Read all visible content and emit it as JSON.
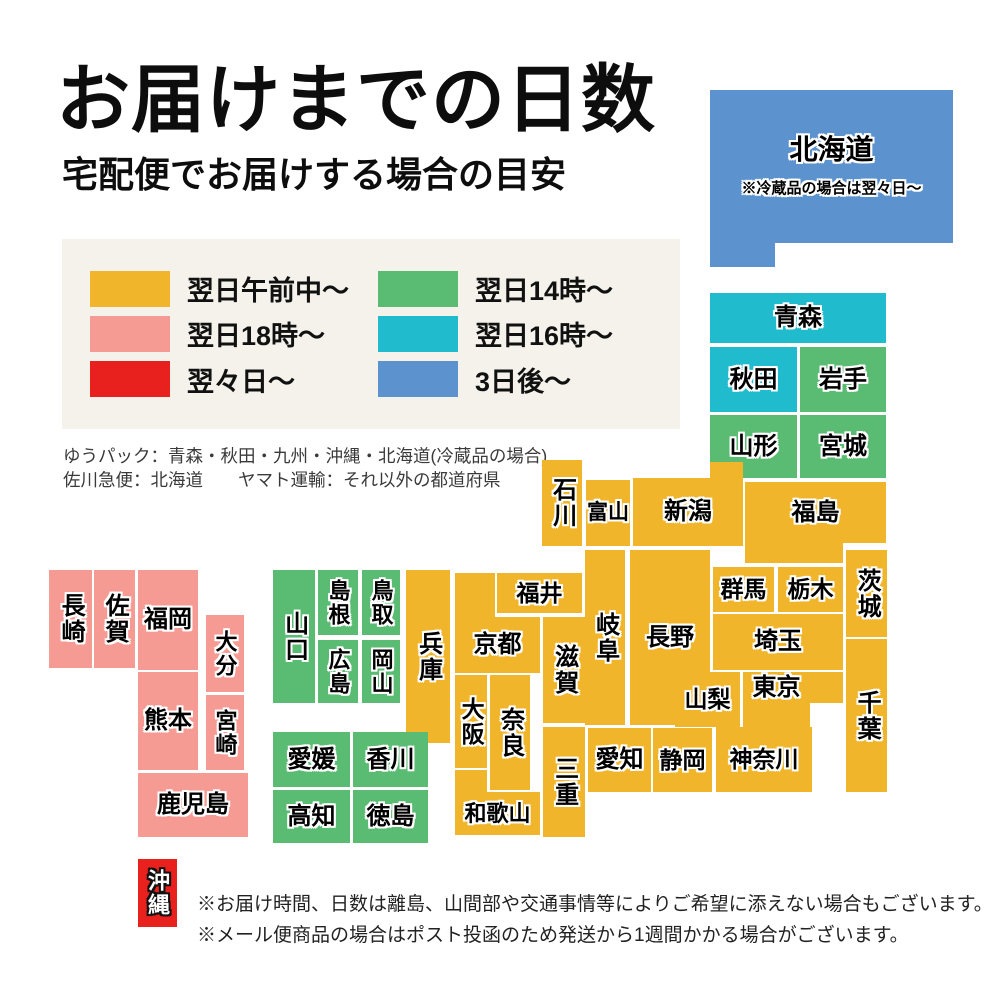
{
  "header": {
    "title": "お届けまでの日数",
    "subtitle": "宅配便でお届けする場合の目安"
  },
  "palette": {
    "next_morning": "#F1B52B",
    "next_18": "#F59B93",
    "two_days": "#E8201E",
    "next_14": "#5ABB72",
    "next_16": "#20BCCE",
    "three_days": "#5C93CE",
    "legend_bg": "#F4F2EB",
    "map_text": "#000000",
    "map_text_outline": "#FFFFFF"
  },
  "legend": {
    "items": [
      {
        "key": "next_morning",
        "label": "翌日午前中〜"
      },
      {
        "key": "next_18",
        "label": "翌日18時〜"
      },
      {
        "key": "two_days",
        "label": "翌々日〜"
      },
      {
        "key": "next_14",
        "label": "翌日14時〜"
      },
      {
        "key": "next_16",
        "label": "翌日16時〜"
      },
      {
        "key": "three_days",
        "label": "3日後〜"
      }
    ]
  },
  "carrier_notes": {
    "line1": "ゆうパック：青森・秋田・九州・沖縄・北海道(冷蔵品の場合)",
    "line2": "佐川急便：北海道　　ヤマト運輸：それ以外の都道府県"
  },
  "map": {
    "blocks": [
      {
        "id": "hokkaido",
        "label": "北海道",
        "note": "※冷蔵品の場合は翌々日〜",
        "color": "three_days",
        "x": 710,
        "y": 90,
        "w": 243,
        "h": 177,
        "fs": 28,
        "pb": 24,
        "clip": [
          [
            0,
            0
          ],
          [
            243,
            0
          ],
          [
            243,
            153
          ],
          [
            65,
            153
          ],
          [
            65,
            177
          ],
          [
            0,
            177
          ]
        ]
      },
      {
        "id": "aomori",
        "label": "青森",
        "color": "next_16",
        "x": 710,
        "y": 293,
        "w": 176,
        "h": 50
      },
      {
        "id": "akita",
        "label": "秋田",
        "color": "next_16",
        "x": 710,
        "y": 347,
        "w": 87,
        "h": 65
      },
      {
        "id": "iwate",
        "label": "岩手",
        "color": "next_14",
        "x": 800,
        "y": 347,
        "w": 86,
        "h": 65
      },
      {
        "id": "yamagata",
        "label": "山形",
        "color": "next_14",
        "x": 710,
        "y": 415,
        "w": 87,
        "h": 63
      },
      {
        "id": "miyagi",
        "label": "宮城",
        "color": "next_14",
        "x": 800,
        "y": 415,
        "w": 86,
        "h": 63
      },
      {
        "id": "niigata",
        "label": "新潟",
        "color": "next_morning",
        "x": 633,
        "y": 462,
        "w": 110,
        "h": 84,
        "pt": 16,
        "clip": [
          [
            77,
            0
          ],
          [
            110,
            0
          ],
          [
            110,
            84
          ],
          [
            0,
            84
          ],
          [
            0,
            16
          ],
          [
            77,
            16
          ]
        ]
      },
      {
        "id": "fukushima",
        "label": "福島",
        "color": "next_morning",
        "x": 745,
        "y": 482,
        "w": 141,
        "h": 81,
        "pb": 20,
        "clip": [
          [
            0,
            0
          ],
          [
            141,
            0
          ],
          [
            141,
            61
          ],
          [
            98,
            61
          ],
          [
            98,
            81
          ],
          [
            0,
            81
          ]
        ]
      },
      {
        "id": "ishikawa",
        "label": "石川",
        "color": "next_morning",
        "x": 542,
        "y": 460,
        "w": 40,
        "h": 86,
        "vertical": true
      },
      {
        "id": "toyama",
        "label": "富山",
        "color": "next_morning",
        "x": 586,
        "y": 480,
        "w": 44,
        "h": 66,
        "fs": 21
      },
      {
        "id": "gunma",
        "label": "群馬",
        "color": "next_morning",
        "x": 713,
        "y": 567,
        "w": 61,
        "h": 45,
        "fs": 23
      },
      {
        "id": "tochigi",
        "label": "栃木",
        "color": "next_morning",
        "x": 778,
        "y": 567,
        "w": 65,
        "h": 45,
        "fs": 23
      },
      {
        "id": "ibaraki",
        "label": "茨城",
        "color": "next_morning",
        "x": 846,
        "y": 550,
        "w": 41,
        "h": 87,
        "vertical": true
      },
      {
        "id": "saitama",
        "label": "埼玉",
        "color": "next_morning",
        "x": 713,
        "y": 614,
        "w": 130,
        "h": 56
      },
      {
        "id": "chiba",
        "label": "千葉",
        "color": "next_morning",
        "x": 846,
        "y": 639,
        "w": 41,
        "h": 153,
        "vertical": true
      },
      {
        "id": "nagano",
        "label": "長野",
        "color": "next_morning",
        "x": 630,
        "y": 550,
        "w": 80,
        "h": 175
      },
      {
        "id": "gifu",
        "label": "岐阜",
        "color": "next_morning",
        "x": 585,
        "y": 550,
        "w": 40,
        "h": 175,
        "vertical": true
      },
      {
        "id": "yamanashi",
        "label": "山梨",
        "color": "next_morning",
        "x": 675,
        "y": 672,
        "w": 65,
        "h": 55,
        "fs": 23
      },
      {
        "id": "tokyo",
        "label": "東京",
        "color": "next_morning",
        "x": 743,
        "y": 672,
        "w": 100,
        "h": 55,
        "pr": 33,
        "pb": 24,
        "clip": [
          [
            0,
            0
          ],
          [
            100,
            0
          ],
          [
            100,
            31
          ],
          [
            67,
            31
          ],
          [
            67,
            55
          ],
          [
            0,
            55
          ]
        ]
      },
      {
        "id": "kanagawa",
        "label": "神奈川",
        "color": "next_morning",
        "x": 716,
        "y": 727,
        "w": 96,
        "h": 65,
        "fs": 23
      },
      {
        "id": "shizuoka",
        "label": "静岡",
        "color": "next_morning",
        "x": 653,
        "y": 728,
        "w": 59,
        "h": 64,
        "fs": 23
      },
      {
        "id": "aichi",
        "label": "愛知",
        "color": "next_morning",
        "x": 588,
        "y": 728,
        "w": 63,
        "h": 64
      },
      {
        "id": "fukui",
        "label": "福井",
        "color": "next_morning",
        "x": 497,
        "y": 573,
        "w": 85,
        "h": 40,
        "fs": 23
      },
      {
        "id": "kyoto",
        "label": "京都",
        "color": "next_morning",
        "x": 455,
        "y": 573,
        "w": 85,
        "h": 100,
        "pt": 44,
        "clip": [
          [
            0,
            0
          ],
          [
            40,
            0
          ],
          [
            40,
            44
          ],
          [
            85,
            44
          ],
          [
            85,
            100
          ],
          [
            0,
            100
          ]
        ]
      },
      {
        "id": "shiga",
        "label": "滋賀",
        "color": "next_morning",
        "x": 543,
        "y": 617,
        "w": 42,
        "h": 106,
        "vertical": true
      },
      {
        "id": "osaka",
        "label": "大阪",
        "color": "next_morning",
        "x": 455,
        "y": 675,
        "w": 32,
        "h": 93,
        "vertical": true,
        "fs": 23
      },
      {
        "id": "nara",
        "label": "奈良",
        "color": "next_morning",
        "x": 490,
        "y": 675,
        "w": 40,
        "h": 115,
        "vertical": true
      },
      {
        "id": "mie",
        "label": "三重",
        "color": "next_morning",
        "x": 543,
        "y": 727,
        "w": 42,
        "h": 110,
        "vertical": true
      },
      {
        "id": "wakayama",
        "label": "和歌山",
        "color": "next_morning",
        "x": 455,
        "y": 770,
        "w": 85,
        "h": 65,
        "fs": 22,
        "pt": 22,
        "clip": [
          [
            0,
            0
          ],
          [
            32,
            0
          ],
          [
            32,
            22
          ],
          [
            85,
            22
          ],
          [
            85,
            65
          ],
          [
            0,
            65
          ]
        ]
      },
      {
        "id": "hyogo",
        "label": "兵庫",
        "color": "next_morning",
        "x": 406,
        "y": 570,
        "w": 44,
        "h": 173,
        "vertical": true
      },
      {
        "id": "yamaguchi",
        "label": "山口",
        "color": "next_14",
        "x": 273,
        "y": 570,
        "w": 42,
        "h": 133,
        "vertical": true
      },
      {
        "id": "shimane",
        "label": "島根",
        "color": "next_14",
        "x": 318,
        "y": 570,
        "w": 40,
        "h": 65,
        "vertical": true,
        "fs": 22
      },
      {
        "id": "tottori",
        "label": "鳥取",
        "color": "next_14",
        "x": 362,
        "y": 570,
        "w": 38,
        "h": 65,
        "vertical": true,
        "fs": 22
      },
      {
        "id": "hiroshima",
        "label": "広島",
        "color": "next_14",
        "x": 318,
        "y": 640,
        "w": 40,
        "h": 63,
        "vertical": true,
        "fs": 22
      },
      {
        "id": "okayama",
        "label": "岡山",
        "color": "next_14",
        "x": 362,
        "y": 640,
        "w": 38,
        "h": 63,
        "vertical": true,
        "fs": 22
      },
      {
        "id": "ehime",
        "label": "愛媛",
        "color": "next_14",
        "x": 273,
        "y": 732,
        "w": 77,
        "h": 55
      },
      {
        "id": "kagawa",
        "label": "香川",
        "color": "next_14",
        "x": 353,
        "y": 732,
        "w": 75,
        "h": 55
      },
      {
        "id": "kochi",
        "label": "高知",
        "color": "next_14",
        "x": 273,
        "y": 790,
        "w": 77,
        "h": 53
      },
      {
        "id": "tokushima",
        "label": "徳島",
        "color": "next_14",
        "x": 353,
        "y": 790,
        "w": 75,
        "h": 53
      },
      {
        "id": "nagasaki",
        "label": "長崎",
        "color": "next_18",
        "x": 49,
        "y": 570,
        "w": 43,
        "h": 98,
        "vertical": true
      },
      {
        "id": "saga",
        "label": "佐賀",
        "color": "next_18",
        "x": 94,
        "y": 570,
        "w": 41,
        "h": 98,
        "vertical": true
      },
      {
        "id": "fukuoka",
        "label": "福岡",
        "color": "next_18",
        "x": 138,
        "y": 570,
        "w": 60,
        "h": 100
      },
      {
        "id": "oita",
        "label": "大分",
        "color": "next_18",
        "x": 206,
        "y": 615,
        "w": 38,
        "h": 77,
        "vertical": true,
        "fs": 22
      },
      {
        "id": "kumamoto",
        "label": "熊本",
        "color": "next_18",
        "x": 138,
        "y": 672,
        "w": 60,
        "h": 98
      },
      {
        "id": "miyazaki",
        "label": "宮崎",
        "color": "next_18",
        "x": 206,
        "y": 695,
        "w": 38,
        "h": 75,
        "vertical": true,
        "fs": 22
      },
      {
        "id": "kagoshima",
        "label": "鹿児島",
        "color": "next_18",
        "x": 138,
        "y": 773,
        "w": 110,
        "h": 64
      },
      {
        "id": "okinawa",
        "label": "沖縄",
        "color": "two_days",
        "x": 138,
        "y": 859,
        "w": 39,
        "h": 68,
        "vertical": true,
        "fs": 22,
        "white_text": true
      }
    ]
  },
  "footer_notes": {
    "line1": "※お届け時間、日数は離島、山間部や交通事情等によりご希望に添えない場合もございます。",
    "line2": "※メール便商品の場合はポスト投函のため発送から1週間かかる場合がございます。"
  }
}
